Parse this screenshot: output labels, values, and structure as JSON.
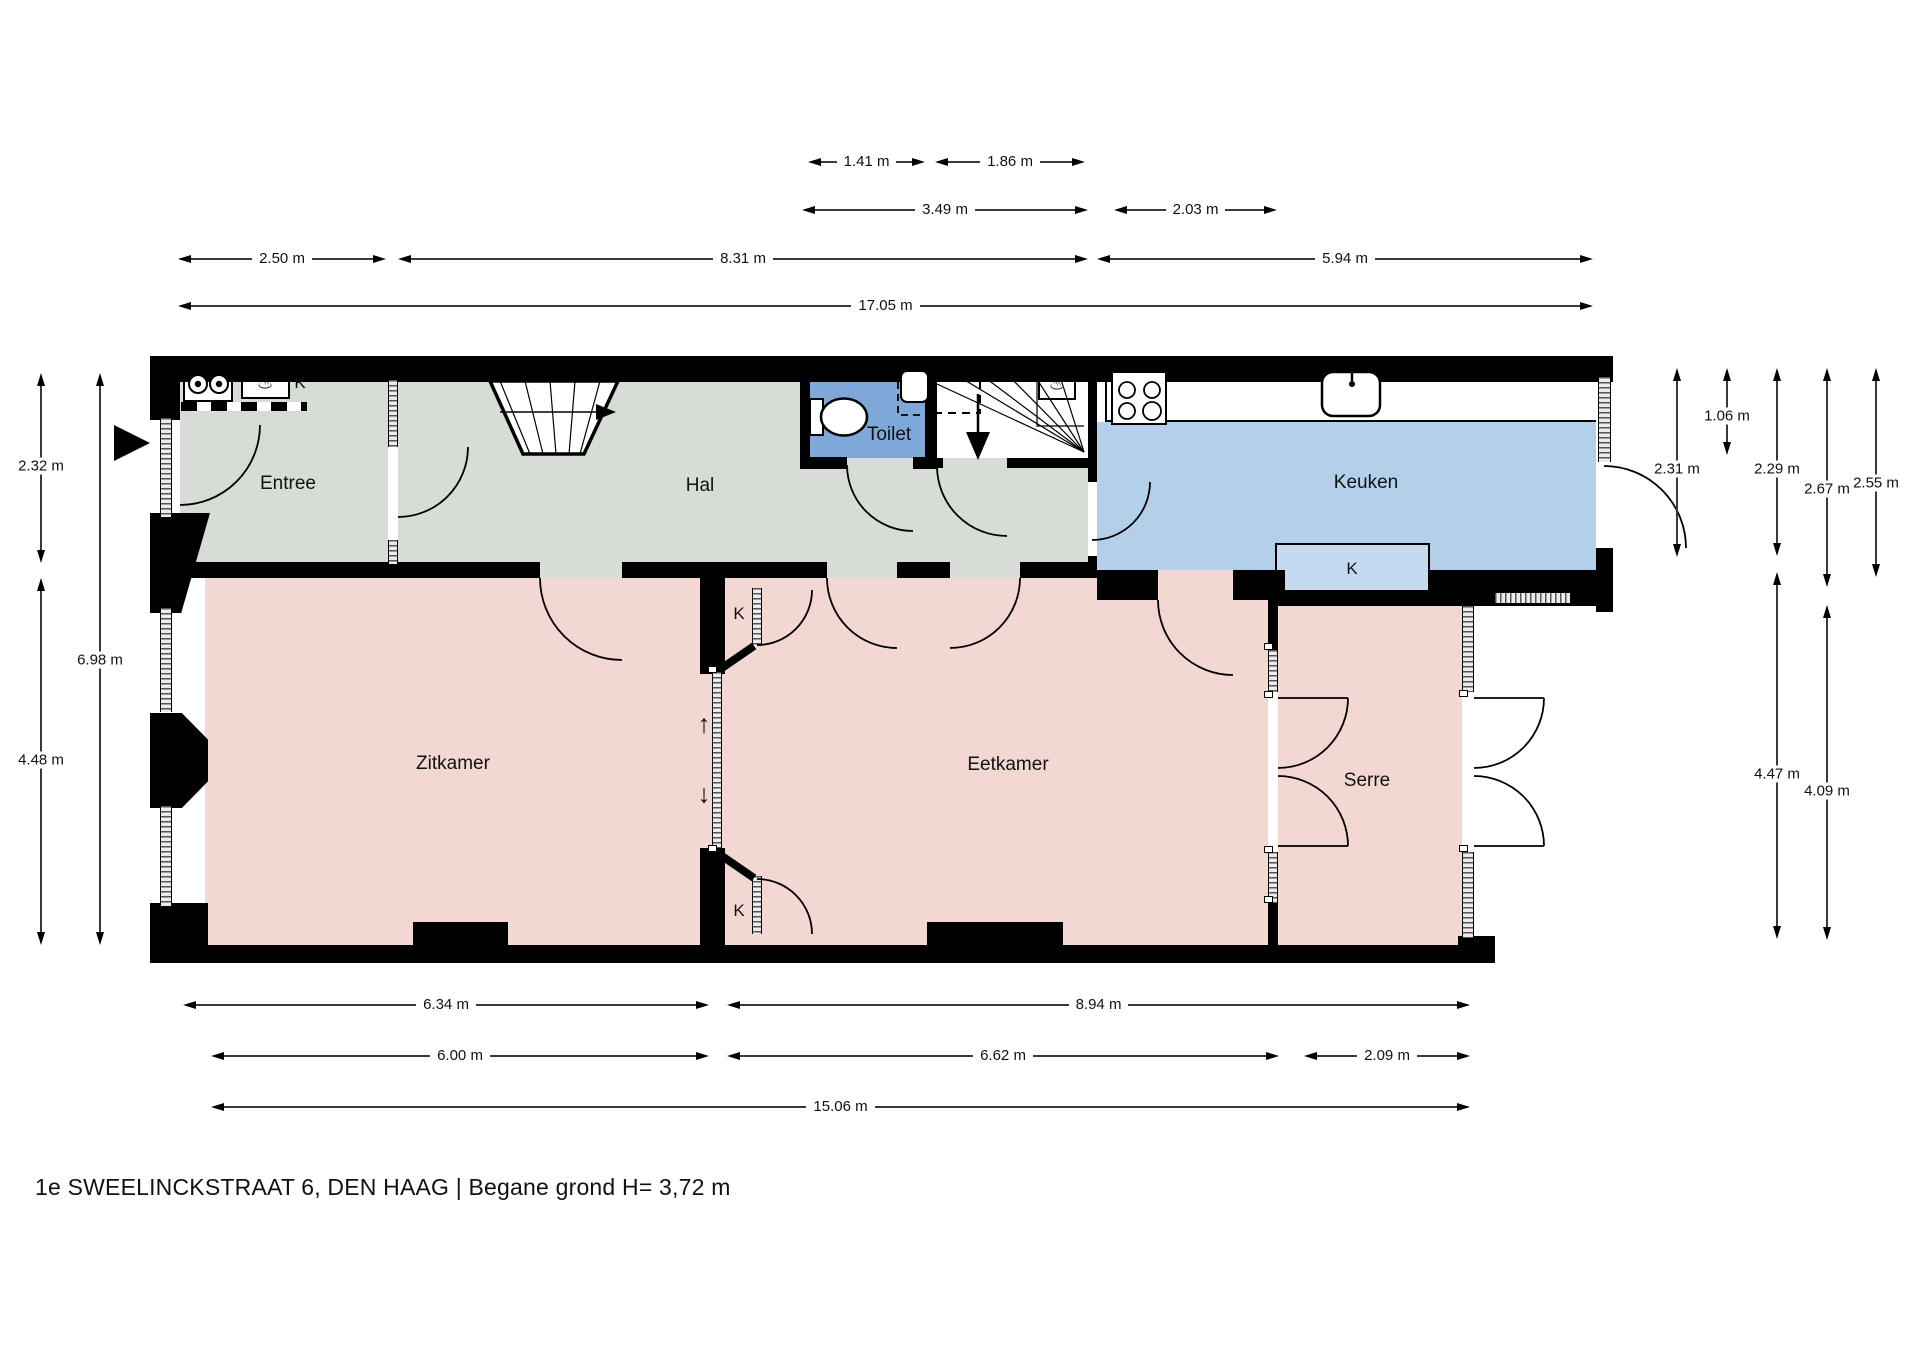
{
  "title": "1e SWEELINCKSTRAAT 6, DEN HAAG | Begane grond H= 3,72 m",
  "rooms": {
    "entree": "Entree",
    "hal": "Hal",
    "toilet": "Toilet",
    "keuken": "Keuken",
    "zitkamer": "Zitkamer",
    "eetkamer": "Eetkamer",
    "serre": "Serre"
  },
  "closet_labels": {
    "meterkast": "K",
    "keuken_kast": "K",
    "ensuite_kast_boven": "K",
    "ensuite_kast_onder": "K"
  },
  "symbols": {
    "stair_up_arrow": "↑",
    "stair_down_arrow": "↓",
    "geyser": "♨"
  },
  "dimensions": {
    "top_row1": [
      "1.41 m",
      "1.86 m"
    ],
    "top_row2": [
      "3.49 m",
      "2.03 m"
    ],
    "top_row3": [
      "2.50 m",
      "8.31 m",
      "5.94 m"
    ],
    "top_total": [
      "17.05 m"
    ],
    "left_col1": [
      "2.32 m",
      "4.48 m"
    ],
    "left_col2": [
      "6.98 m"
    ],
    "right": [
      "2.31 m",
      "1.06 m",
      "2.29 m",
      "2.67 m",
      "2.55 m",
      "4.47 m",
      "4.09 m"
    ],
    "bottom_row1": [
      "6.34 m",
      "8.94 m"
    ],
    "bottom_row2": [
      "6.00 m",
      "6.62 m",
      "2.09 m"
    ],
    "bottom_total": [
      "15.06 m"
    ]
  },
  "colors": {
    "floor_pink": "#f3d7d3",
    "floor_gray": "#d7dcd7",
    "toilet_blue": "#7fa8d9",
    "keuken_blue": "#b3cfe9",
    "kast_blue": "#c3daf0",
    "wall": "#000000"
  }
}
